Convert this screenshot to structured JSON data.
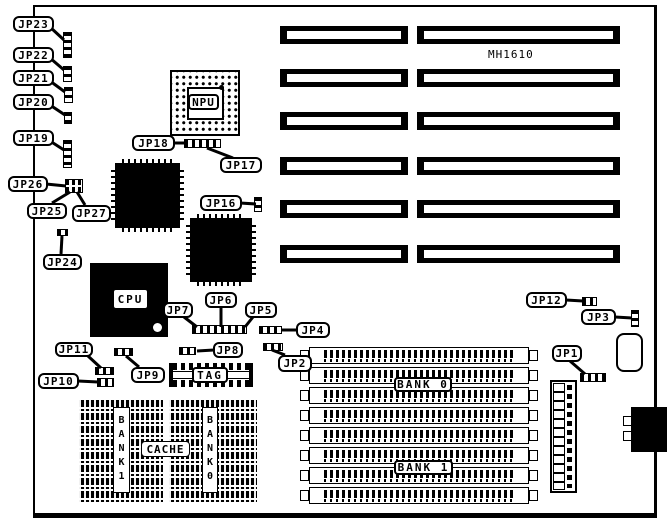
{
  "board": {
    "model": "MH1610"
  },
  "colors": {
    "ink": "#000000",
    "paper": "#ffffff"
  },
  "jumpers": {
    "jp1": "JP1",
    "jp2": "JP2",
    "jp3": "JP3",
    "jp4": "JP4",
    "jp5": "JP5",
    "jp6": "JP6",
    "jp7": "JP7",
    "jp8": "JP8",
    "jp9": "JP9",
    "jp10": "JP10",
    "jp11": "JP11",
    "jp12": "JP12",
    "jp16": "JP16",
    "jp17": "JP17",
    "jp18": "JP18",
    "jp19": "JP19",
    "jp20": "JP20",
    "jp21": "JP21",
    "jp22": "JP22",
    "jp23": "JP23",
    "jp24": "JP24",
    "jp25": "JP25",
    "jp26": "JP26",
    "jp27": "JP27"
  },
  "chips": {
    "npu": "NPU",
    "cpu": "CPU",
    "tag": "TAG",
    "cache": "CACHE",
    "cache_bank1": "BANK1",
    "cache_bank0": "BANK0"
  },
  "memory": {
    "bank0": "BANK 0",
    "bank1": "BANK 1"
  }
}
